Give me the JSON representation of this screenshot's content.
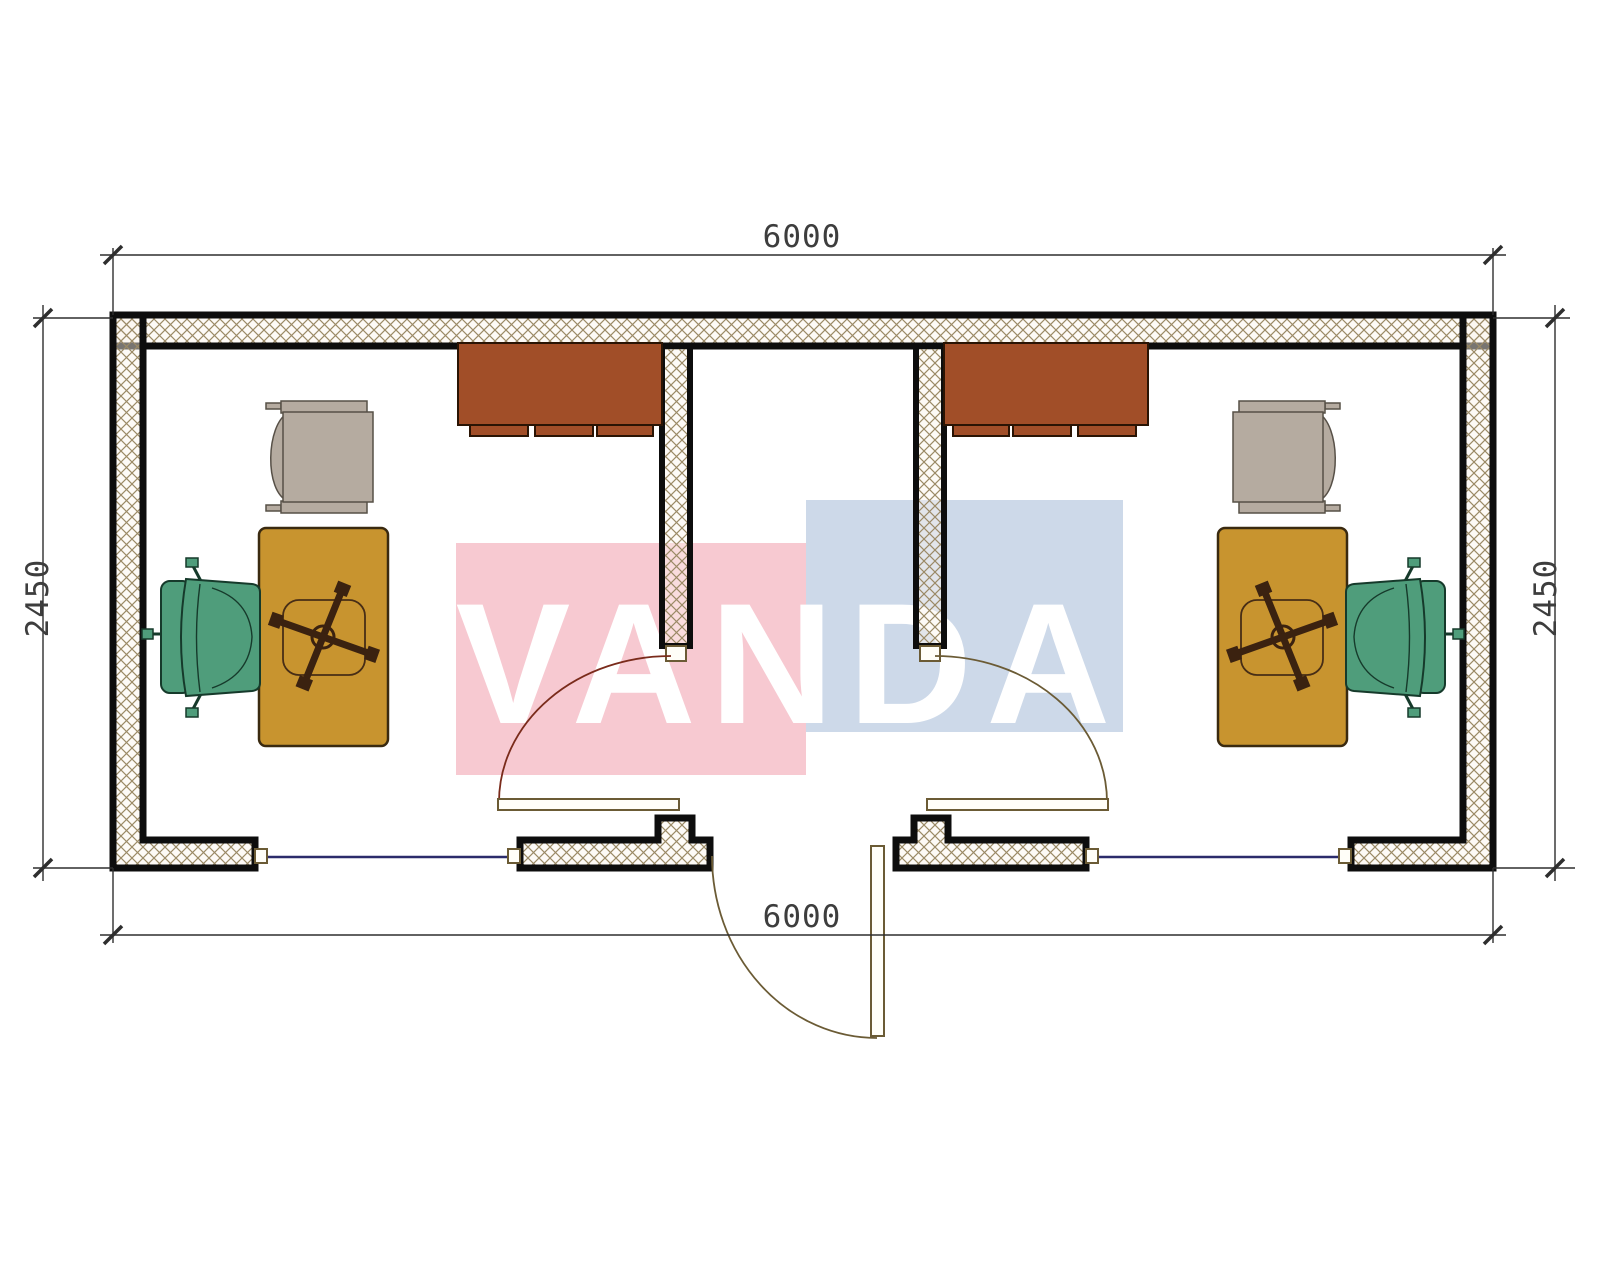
{
  "watermark": {
    "text": "VANDA",
    "left_block_color": "#f7c9d1",
    "right_block_color": "#cdd9e9",
    "text_color": "#ffffff"
  },
  "dimensions": {
    "top_width": "6000",
    "bottom_width": "6000",
    "left_height": "2450",
    "right_height": "2450",
    "line_color": "#2e2e2e",
    "text_color": "#3d3d3d"
  },
  "plan_colors": {
    "wall_outline": "#0d0d0d",
    "hatch_line": "#9b8a66",
    "window_line": "#2b2b6b",
    "door_leaf_outline": "#6b5b35",
    "door_arc_left": "#7a2b1b",
    "door_arc_right": "#6b5b35",
    "door_arc_entrance": "#6b5b35",
    "door_stop_fill": "#fffef8"
  },
  "furniture_colors": {
    "cabinet": "#a14e28",
    "cabinet_outline": "#2a1404",
    "desk": "#c8942f",
    "desk_outline": "#3a2a10",
    "armchair": "#b5aba0",
    "armchair_outline": "#575047",
    "office_chair": "#4f9d7b",
    "office_chair_outline": "#163a2b",
    "chair_base": "#3b2210"
  }
}
